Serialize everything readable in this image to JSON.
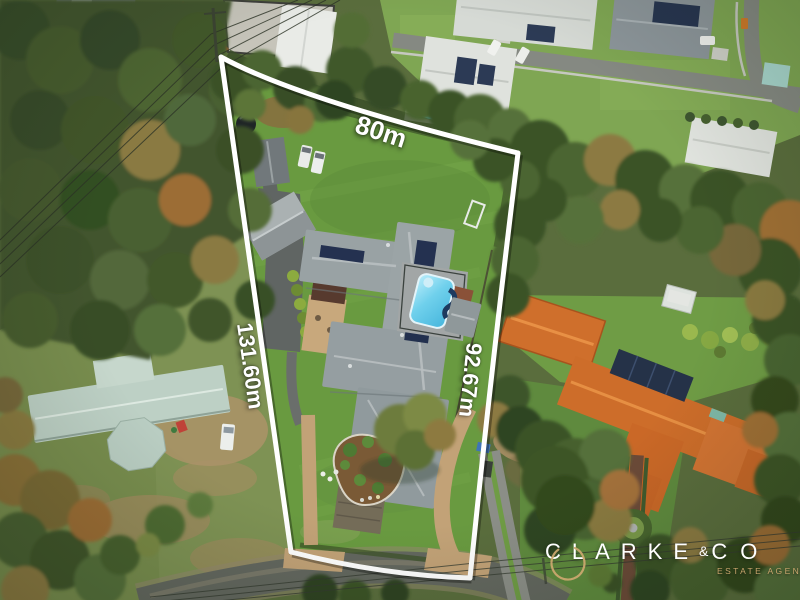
{
  "photo": {
    "type": "aerial-drone-photograph",
    "subject": "Acreage property with surveyed boundary overlay"
  },
  "boundary": {
    "line_color": "#ffffff",
    "sides": [
      {
        "position": "top",
        "length_label": "80m"
      },
      {
        "position": "left",
        "length_label": "131.60m"
      },
      {
        "position": "right",
        "length_label": "92.67m"
      }
    ]
  },
  "watermark": {
    "brand_primary": "CLARKE",
    "brand_ampersand": "&",
    "brand_secondary": "CO",
    "tagline": "ESTATE AGENTS",
    "text_color": "#ffffff",
    "accent_color": "#c9a66e"
  }
}
